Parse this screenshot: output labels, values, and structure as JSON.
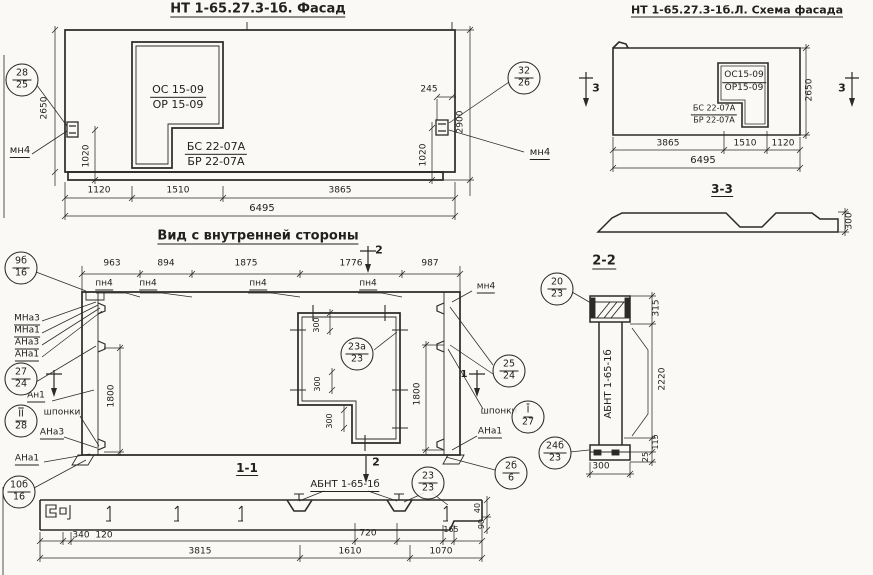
{
  "meta": {
    "drawing_type": "structural panel drawing",
    "paper_color": "#faf9f5",
    "ink_color": "#2b2a26"
  },
  "titles": {
    "facade": "НТ 1-65.27.3-1б. Фасад",
    "schema": "НТ 1-65.27.3-1б.Л. Схема фасада",
    "interior": "Вид с внутренней стороны",
    "section_1_1": "1-1",
    "section_2_2": "2-2",
    "section_3_3": "3-3"
  },
  "annotations": [
    {
      "n": "facade-title",
      "tx": "НТ 1-65.27.3-1б. Фасад",
      "x": 258,
      "y": 10,
      "u": 1,
      "s": 13,
      "b": 1
    },
    {
      "n": "facade-window-mark",
      "t": "frac",
      "a": "ОС 15-09",
      "b2": "ОР 15-09",
      "x": 178,
      "y": 97,
      "s": 11
    },
    {
      "n": "facade-door-mark",
      "t": "frac",
      "a": "БС 22-07А",
      "b2": "БР 22-07А",
      "x": 216,
      "y": 154,
      "s": 11
    },
    {
      "n": "callout-28-25",
      "t": "circle",
      "a": "28",
      "b2": "25",
      "x": 22,
      "y": 80
    },
    {
      "n": "callout-32-26",
      "t": "circle",
      "a": "32",
      "b2": "26",
      "x": 524,
      "y": 78
    },
    {
      "n": "anchor-label-mn4-left",
      "tx": "мн4",
      "x": 20,
      "y": 152,
      "u": 1,
      "s": 10
    },
    {
      "n": "anchor-label-mn4-right",
      "tx": "мн4",
      "x": 540,
      "y": 154,
      "u": 1,
      "s": 10
    },
    {
      "n": "dim-2650-facade",
      "tx": "2650",
      "x": 45,
      "y": 108,
      "r": 1,
      "s": 9
    },
    {
      "n": "dim-1020-facade-left",
      "tx": "1020",
      "x": 87,
      "y": 156,
      "r": 1,
      "s": 9
    },
    {
      "n": "dim-245-facade",
      "tx": "245",
      "x": 429,
      "y": 90,
      "s": 9
    },
    {
      "n": "dim-2900-facade",
      "tx": "2900",
      "x": 461,
      "y": 122,
      "r": 1,
      "s": 9
    },
    {
      "n": "dim-1020-facade-right",
      "tx": "1020",
      "x": 424,
      "y": 155,
      "r": 1,
      "s": 9
    },
    {
      "n": "dim-1120-facade",
      "tx": "1120",
      "x": 99,
      "y": 191,
      "s": 9
    },
    {
      "n": "dim-1510-facade",
      "tx": "1510",
      "x": 178,
      "y": 191,
      "s": 9
    },
    {
      "n": "dim-3865-facade",
      "tx": "3865",
      "x": 340,
      "y": 191,
      "s": 9
    },
    {
      "n": "dim-6495-facade",
      "tx": "6495",
      "x": 262,
      "y": 209,
      "s": 10
    },
    {
      "n": "schema-title",
      "tx": "НТ 1-65.27.3-1б.Л. Схема фасада",
      "x": 737,
      "y": 11,
      "u": 1,
      "s": 11,
      "b": 1
    },
    {
      "n": "schema-window-mark",
      "t": "frac",
      "a": "ОС15-09",
      "b2": "ОР15-09",
      "x": 744,
      "y": 82,
      "s": 9
    },
    {
      "n": "schema-door-mark",
      "t": "frac",
      "a": "БС 22-07А",
      "b2": "БР 22-07А",
      "x": 714,
      "y": 114,
      "s": 8
    },
    {
      "n": "dim-2650-schema",
      "tx": "2650",
      "x": 810,
      "y": 90,
      "r": 1,
      "s": 9
    },
    {
      "n": "section-mark-3-left",
      "tx": "3",
      "x": 596,
      "y": 88,
      "s": 11,
      "b": 1
    },
    {
      "n": "section-mark-3-right",
      "tx": "3",
      "x": 842,
      "y": 88,
      "s": 11,
      "b": 1
    },
    {
      "n": "dim-3865-schema",
      "tx": "3865",
      "x": 668,
      "y": 144,
      "s": 9
    },
    {
      "n": "dim-1510-schema",
      "tx": "1510",
      "x": 745,
      "y": 144,
      "s": 9
    },
    {
      "n": "dim-1120-schema",
      "tx": "1120",
      "x": 783,
      "y": 144,
      "s": 9
    },
    {
      "n": "dim-6495-schema",
      "tx": "6495",
      "x": 703,
      "y": 161,
      "s": 10
    },
    {
      "n": "section-3-3-title",
      "tx": "3-3",
      "x": 722,
      "y": 190,
      "u": 1,
      "s": 12,
      "b": 1
    },
    {
      "n": "dim-300-section33",
      "tx": "300",
      "x": 850,
      "y": 221,
      "r": 1,
      "s": 9
    },
    {
      "n": "interior-title",
      "tx": "Вид с внутренней стороны",
      "x": 258,
      "y": 237,
      "u": 1,
      "s": 13,
      "b": 1
    },
    {
      "n": "dim-963-interior",
      "tx": "963",
      "x": 112,
      "y": 264,
      "s": 9
    },
    {
      "n": "dim-894-interior",
      "tx": "894",
      "x": 166,
      "y": 264,
      "s": 9
    },
    {
      "n": "dim-1875-interior",
      "tx": "1875",
      "x": 246,
      "y": 264,
      "s": 9
    },
    {
      "n": "dim-1776-interior",
      "tx": "1776",
      "x": 351,
      "y": 264,
      "s": 9
    },
    {
      "n": "dim-987-interior",
      "tx": "987",
      "x": 430,
      "y": 264,
      "s": 9
    },
    {
      "n": "joint-label-pn4-1",
      "tx": "пн4",
      "x": 104,
      "y": 285,
      "u": 1,
      "s": 9
    },
    {
      "n": "joint-label-pn4-2",
      "tx": "пн4",
      "x": 148,
      "y": 285,
      "u": 1,
      "s": 9
    },
    {
      "n": "joint-label-pn4-3",
      "tx": "пн4",
      "x": 258,
      "y": 285,
      "u": 1,
      "s": 9
    },
    {
      "n": "joint-label-pn4-4",
      "tx": "пн4",
      "x": 368,
      "y": 285,
      "u": 1,
      "s": 9
    },
    {
      "n": "anchor-label-mn4-interior",
      "tx": "мн4",
      "x": 486,
      "y": 288,
      "u": 1,
      "s": 9
    },
    {
      "n": "section-mark-2-top",
      "tx": "2",
      "x": 379,
      "y": 250,
      "s": 11,
      "b": 1
    },
    {
      "n": "section-mark-2-bottom",
      "tx": "2",
      "x": 376,
      "y": 462,
      "s": 11,
      "b": 1
    },
    {
      "n": "label-mna3-top",
      "tx": "МНа3",
      "x": 27,
      "y": 320,
      "u": 1,
      "s": 9
    },
    {
      "n": "label-mna1-top",
      "tx": "МНа1",
      "x": 27,
      "y": 332,
      "u": 1,
      "s": 9
    },
    {
      "n": "label-ana3-top",
      "tx": "АНа3",
      "x": 27,
      "y": 344,
      "u": 1,
      "s": 9
    },
    {
      "n": "label-ana1-top",
      "tx": "АНа1",
      "x": 27,
      "y": 356,
      "u": 1,
      "s": 9
    },
    {
      "n": "label-an1",
      "tx": "Ан1",
      "x": 36,
      "y": 397,
      "u": 1,
      "s": 9
    },
    {
      "n": "section-mark-1-right",
      "tx": "1",
      "x": 464,
      "y": 375,
      "s": 10,
      "b": 1
    },
    {
      "n": "label-shponki-left",
      "tx": "шпонки",
      "x": 62,
      "y": 413,
      "s": 9
    },
    {
      "n": "label-shponki-right",
      "tx": "шпонки",
      "x": 499,
      "y": 412,
      "s": 9
    },
    {
      "n": "label-ana3-bottom",
      "tx": "АНа3",
      "x": 52,
      "y": 434,
      "u": 1,
      "s": 9
    },
    {
      "n": "label-ana1-bottom",
      "tx": "АНа1",
      "x": 27,
      "y": 460,
      "u": 1,
      "s": 9
    },
    {
      "n": "label-ana1-right",
      "tx": "АНа1",
      "x": 490,
      "y": 433,
      "u": 1,
      "s": 9
    },
    {
      "n": "callout-9b-16",
      "t": "circle",
      "a": "9б",
      "b2": "16",
      "x": 21,
      "y": 268
    },
    {
      "n": "callout-27-24",
      "t": "circle",
      "a": "27",
      "b2": "24",
      "x": 21,
      "y": 379
    },
    {
      "n": "callout-II-28",
      "t": "circle",
      "a": "II",
      "b2": "28",
      "ov": 1,
      "x": 21,
      "y": 421
    },
    {
      "n": "callout-10b-16",
      "t": "circle",
      "a": "10б",
      "b2": "16",
      "x": 19,
      "y": 492
    },
    {
      "n": "callout-25-24",
      "t": "circle",
      "a": "25",
      "b2": "24",
      "x": 509,
      "y": 371
    },
    {
      "n": "callout-I-27",
      "t": "circle",
      "a": "I",
      "b2": "27",
      "ov": 1,
      "x": 528,
      "y": 417
    },
    {
      "n": "callout-2b-6",
      "t": "circle",
      "a": "2б",
      "b2": "6",
      "x": 511,
      "y": 473
    },
    {
      "n": "callout-23a-23",
      "t": "circle",
      "a": "23а",
      "b2": "23",
      "x": 357,
      "y": 354
    },
    {
      "n": "callout-23-23",
      "t": "circle",
      "a": "23",
      "b2": "23",
      "x": 428,
      "y": 483
    },
    {
      "n": "callout-20-23",
      "t": "circle",
      "a": "20",
      "b2": "23",
      "x": 557,
      "y": 289
    },
    {
      "n": "callout-24b-23",
      "t": "circle",
      "a": "24б",
      "b2": "23",
      "x": 555,
      "y": 453
    },
    {
      "n": "dim-1800-left",
      "tx": "1800",
      "x": 112,
      "y": 396,
      "r": 1,
      "s": 9
    },
    {
      "n": "dim-1800-right",
      "tx": "1800",
      "x": 418,
      "y": 394,
      "r": 1,
      "s": 9
    },
    {
      "n": "dim-300-opening-1",
      "tx": "300",
      "x": 317,
      "y": 325,
      "r": 1,
      "s": 8
    },
    {
      "n": "dim-300-opening-2",
      "tx": "300",
      "x": 318,
      "y": 384,
      "r": 1,
      "s": 8
    },
    {
      "n": "dim-300-opening-3",
      "tx": "300",
      "x": 330,
      "y": 421,
      "r": 1,
      "s": 8
    },
    {
      "n": "section-1-1-title",
      "tx": "1-1",
      "x": 247,
      "y": 469,
      "u": 1,
      "s": 12,
      "b": 1
    },
    {
      "n": "label-abnt-section11",
      "tx": "АБНТ 1-65-1б",
      "x": 345,
      "y": 486,
      "u": 1,
      "s": 10
    },
    {
      "n": "dim-340-section11",
      "tx": "340",
      "x": 81,
      "y": 536,
      "s": 9
    },
    {
      "n": "dim-120-section11",
      "tx": "120",
      "x": 104,
      "y": 536,
      "s": 9
    },
    {
      "n": "dim-720-section11",
      "tx": "720",
      "x": 368,
      "y": 534,
      "s": 9
    },
    {
      "n": "dim-165-section11",
      "tx": "165",
      "x": 451,
      "y": 530,
      "s": 8
    },
    {
      "n": "dim-3815-section11",
      "tx": "3815",
      "x": 200,
      "y": 552,
      "s": 9
    },
    {
      "n": "dim-1610-section11",
      "tx": "1610",
      "x": 350,
      "y": 552,
      "s": 9
    },
    {
      "n": "dim-1070-section11",
      "tx": "1070",
      "x": 441,
      "y": 552,
      "s": 9
    },
    {
      "n": "dim-40-section11",
      "tx": "40",
      "x": 478,
      "y": 508,
      "r": 1,
      "s": 8
    },
    {
      "n": "dim-90-section11",
      "tx": "90",
      "x": 482,
      "y": 524,
      "r": 1,
      "s": 8
    },
    {
      "n": "section-2-2-title",
      "tx": "2-2",
      "x": 604,
      "y": 262,
      "u": 1,
      "s": 13,
      "b": 1
    },
    {
      "n": "label-abnt-section22",
      "tx": "АБНТ 1-65-1б",
      "x": 609,
      "y": 384,
      "r": 1,
      "s": 10
    },
    {
      "n": "dim-315-section22",
      "tx": "315",
      "x": 657,
      "y": 308,
      "r": 1,
      "s": 9
    },
    {
      "n": "dim-2220-section22",
      "tx": "2220",
      "x": 663,
      "y": 379,
      "r": 1,
      "s": 9
    },
    {
      "n": "dim-115-section22",
      "tx": "115",
      "x": 656,
      "y": 442,
      "r": 1,
      "s": 8
    },
    {
      "n": "dim-25-section22",
      "tx": "25",
      "x": 646,
      "y": 457,
      "r": 1,
      "s": 8
    },
    {
      "n": "dim-300-section22",
      "tx": "300",
      "x": 601,
      "y": 467,
      "s": 9
    }
  ]
}
